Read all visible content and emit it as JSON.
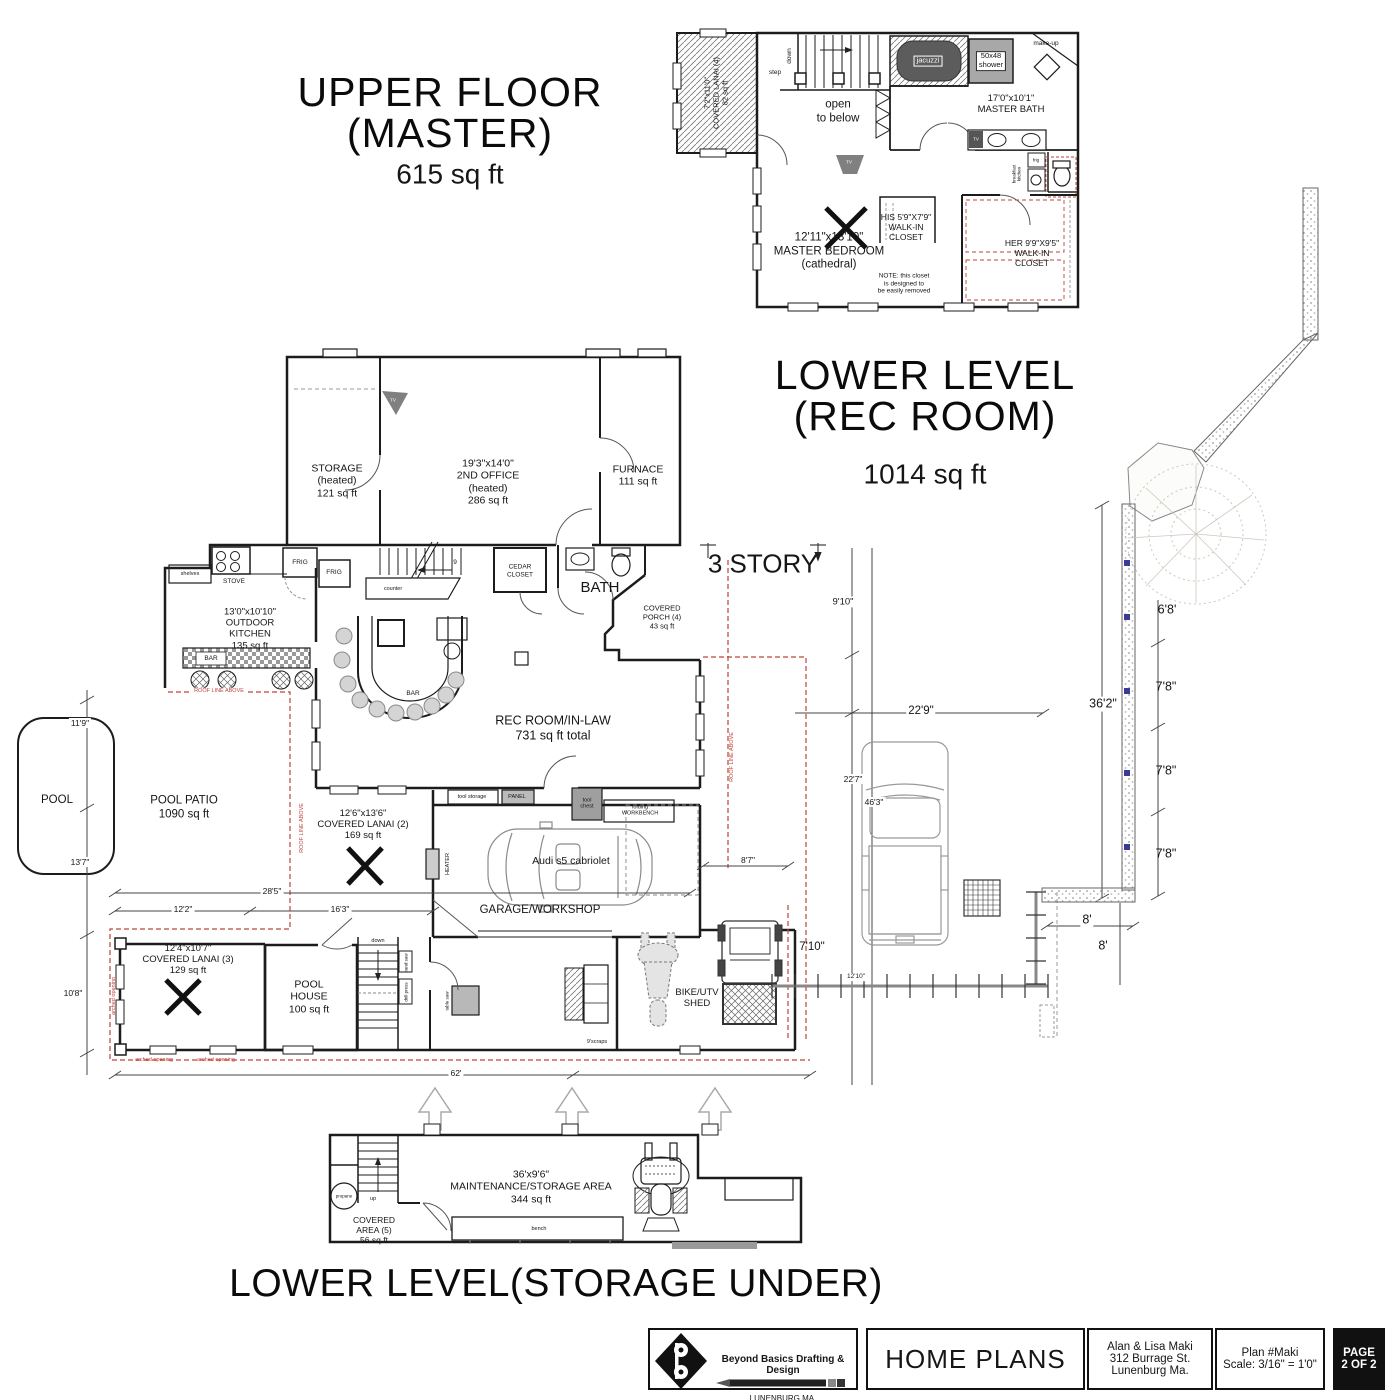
{
  "titles": {
    "upper1": "UPPER FLOOR",
    "upper2": "(MASTER)",
    "upper3": "615 sq ft",
    "lower1": "LOWER LEVEL",
    "lower2": "(REC ROOM)",
    "lower3": "1014 sq ft",
    "storage_under": "LOWER LEVEL(STORAGE UNDER)",
    "three_story": "3 STORY"
  },
  "upper": {
    "lanai4": "7'2\"x11'0\"\nCOVERED LANAI (4)\n82 sq ft",
    "step": "step",
    "down": "down",
    "open": "open\nto below",
    "jacuzzi": "jacuzzi",
    "shower": "50x48\nshower",
    "makeup": "make-up",
    "bath": "17'0\"x10'1\"\nMASTER BATH",
    "tv_bath": "TV",
    "frig": "frig",
    "breakfast": "breakfast\nkitchen",
    "bedroom": "12'11\"x13'10\"\nMASTER BEDROOM\n(cathedral)",
    "tv_bed": "TV",
    "his": "HIS 5'9\"X7'9\"\nWALK-IN\nCLOSET",
    "note": "NOTE: this closet\nis designed to\nbe easily removed",
    "her": "HER 9'9\"X9'5\"\nWALK-IN\nCLOSET"
  },
  "main": {
    "storage": "STORAGE\n(heated)\n121 sq ft",
    "office": "19'3\"x14'0\"\n2ND OFFICE\n(heated)\n286 sq ft",
    "furnace": "FURNACE\n111 sq ft",
    "tv_office": "TV",
    "shelves": "shelves",
    "stove": "STOVE",
    "frig1": "FRIG",
    "frig2": "FRIG",
    "stair9": "9",
    "counter": "counter",
    "cedar": "CEDAR\nCLOSET",
    "bath": "BATH",
    "porch": "COVERED\nPORCH (4)\n43 sq ft",
    "outdoor_kitchen": "13'0\"x10'10\"\nOUTDOOR\nKITCHEN\n135 sq ft",
    "bar1": "BAR",
    "bar2": "BAR",
    "roof1": "ROOF LINE ABOVE",
    "roof2": "ROOF LINE ABOVE",
    "roof3": "ROOF LINE ABOVE",
    "rec": "REC ROOM/IN-LAW\n731  sq ft total",
    "pool": "POOL",
    "patio": "POOL PATIO\n1090 sq ft",
    "lanai2": "12'6\"x13'6\"\nCOVERED LANAI (2)\n169 sq ft",
    "heater": "HEATER",
    "tool_storage": "tool storage",
    "panel": "PANEL",
    "tool_chest": "tool\nchest",
    "workbench": "folding\nWORKBENCH",
    "car": "Audi s5 cabriolet",
    "garage": "GARAGE/WORKSHOP",
    "lanai3": "12'4\"x10'7\"\nCOVERED LANAI (3)\n129 sq ft",
    "pool_house": "POOL\nHOUSE\n100 sq ft",
    "down2": "down",
    "band_saw": "band saw",
    "drill_press": "drill press",
    "table_saw": "table saw",
    "scraps": "9'scraps",
    "shed": "BIKE/UTV\nSHED",
    "arch1": "arched opening",
    "arch2": "arched opening",
    "arch3": "arched opening"
  },
  "dims": {
    "h11_9": "11'9\"",
    "h13_7": "13'7\"",
    "h10_8": "10'8\"",
    "w28_5": "28'5\"",
    "w12_2": "12'2\"",
    "w16_3": "16'3\"",
    "w62": "62'",
    "w8_7": "8'7\"",
    "w7_10": "7'10\"",
    "w12_10": "12'10\"",
    "v9_10": "9'10\"",
    "w22_9": "22'9\"",
    "v22_7": "22'7\"",
    "v46_3": "46'3\"",
    "v36_2": "36'2\"",
    "r6_8": "6'8'",
    "r7_8a": "7'8\"",
    "r7_8b": "7'8\"",
    "r7_8c": "7'8\"",
    "e8a": "8'",
    "e8b": "8'"
  },
  "bottom": {
    "maint": "36'x9'6\"\nMAINTENANCE/STORAGE AREA\n344 sq ft",
    "bench": "bench",
    "propane": "propane",
    "up": "up",
    "covered": "COVERED\nAREA (5)\n56 sq ft"
  },
  "tb": {
    "company": "Beyond Basics Drafting & Design",
    "loc": "LUNENBURG MA.",
    "web": "beyondbasicsdrafting.com",
    "home": "HOME PLANS",
    "client": "Alan & Lisa Maki\n312 Burrage St.\nLunenburg Ma.",
    "plan": "Plan #Maki\nScale: 3/16\" = 1'0\"",
    "page": "PAGE\n2 OF 2"
  },
  "colors": {
    "roof_line_red": "#bf4338",
    "wall_black": "#1c1c1c",
    "marker_blue": "#3b3b96"
  }
}
